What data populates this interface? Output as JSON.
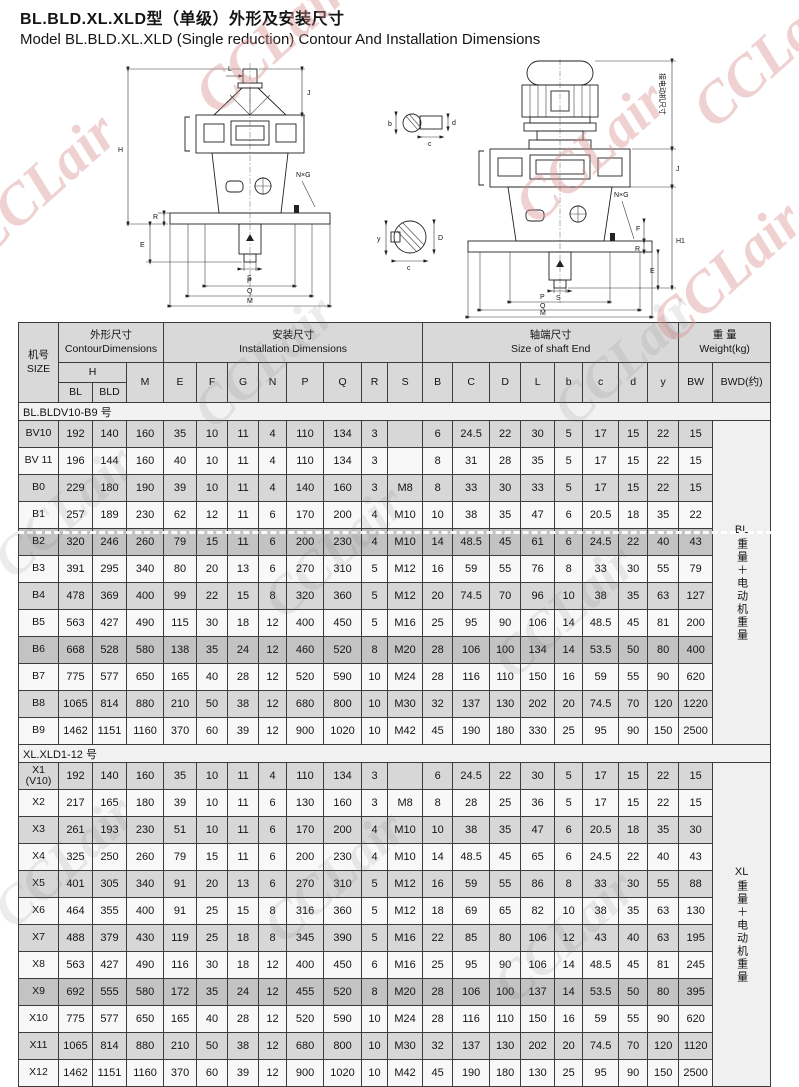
{
  "page": {
    "title_zh": "BL.BLD.XL.XLD型（单级）外形及安装尺寸",
    "title_en": "Model BL.BLD.XL.XLD  (Single  reduction) Contour And Installation Dimensions"
  },
  "watermark": {
    "text": "CCLair"
  },
  "drawings": {
    "left": {
      "H": "H",
      "L": "L",
      "J": "J",
      "NXG": "N×G",
      "E": "E",
      "R": "R",
      "S": "S",
      "P": "P",
      "Q": "Q",
      "M": "M"
    },
    "right": {
      "motor": "接电动机尺寸",
      "J": "J",
      "H1": "H1",
      "NXG": "N×G",
      "F": "F",
      "R": "R",
      "E": "E",
      "S": "S",
      "P": "P",
      "Q": "Q",
      "M": "M"
    },
    "detail_top": {
      "b": "b",
      "d": "d",
      "c": "c"
    },
    "detail_bottom": {
      "y": "y",
      "D": "D",
      "c": "c"
    }
  },
  "table": {
    "col_size_zh": "机号",
    "col_size_en": "SIZE",
    "grp_contour_zh": "外形尺寸",
    "grp_contour_en": "ContourDimensions",
    "grp_install_zh": "安装尺寸",
    "grp_install_en": "Installation   Dimensions",
    "grp_shaft_zh": "轴端尺寸",
    "grp_shaft_en": "Size of shaft End",
    "grp_weight_zh": "重 量",
    "grp_weight_en": "Weight(kg)",
    "col_h": "H",
    "col_bl": "BL",
    "col_bld": "BLD",
    "cols": [
      "M",
      "E",
      "F",
      "G",
      "N",
      "P",
      "Q",
      "R",
      "S",
      "B",
      "C",
      "D",
      "L",
      "b",
      "c",
      "d",
      "y",
      "BW",
      "BWD(约)"
    ],
    "sections": [
      {
        "label": "BL.BLDV10-B9 号",
        "weight_label": "BL",
        "weight_note": "重量＋电动机重量",
        "rows": [
          {
            "size": "BV10",
            "shade": "gray",
            "values": [
              "192",
              "140",
              "160",
              "35",
              "10",
              "11",
              "4",
              "110",
              "134",
              "3",
              "",
              "6",
              "24.5",
              "22",
              "30",
              "5",
              "17",
              "15",
              "22",
              "15"
            ]
          },
          {
            "size": "BV 11",
            "shade": "white",
            "values": [
              "196",
              "144",
              "160",
              "40",
              "10",
              "11",
              "4",
              "110",
              "134",
              "3",
              "",
              "8",
              "31",
              "28",
              "35",
              "5",
              "17",
              "15",
              "22",
              "15"
            ]
          },
          {
            "size": "B0",
            "shade": "gray",
            "values": [
              "229",
              "180",
              "190",
              "39",
              "10",
              "11",
              "4",
              "140",
              "160",
              "3",
              "M8",
              "8",
              "33",
              "30",
              "33",
              "5",
              "17",
              "15",
              "22",
              "15"
            ]
          },
          {
            "size": "B1",
            "shade": "white",
            "values": [
              "257",
              "189",
              "230",
              "62",
              "12",
              "11",
              "6",
              "170",
              "200",
              "4",
              "M10",
              "10",
              "38",
              "35",
              "47",
              "6",
              "20.5",
              "18",
              "35",
              "22"
            ]
          },
          {
            "size": "B2",
            "shade": "dark",
            "values": [
              "320",
              "246",
              "260",
              "79",
              "15",
              "11",
              "6",
              "200",
              "230",
              "4",
              "M10",
              "14",
              "48.5",
              "45",
              "61",
              "6",
              "24.5",
              "22",
              "40",
              "43"
            ]
          },
          {
            "size": "B3",
            "shade": "white",
            "values": [
              "391",
              "295",
              "340",
              "80",
              "20",
              "13",
              "6",
              "270",
              "310",
              "5",
              "M12",
              "16",
              "59",
              "55",
              "76",
              "8",
              "33",
              "30",
              "55",
              "79"
            ]
          },
          {
            "size": "B4",
            "shade": "gray",
            "values": [
              "478",
              "369",
              "400",
              "99",
              "22",
              "15",
              "8",
              "320",
              "360",
              "5",
              "M12",
              "20",
              "74.5",
              "70",
              "96",
              "10",
              "38",
              "35",
              "63",
              "127"
            ]
          },
          {
            "size": "B5",
            "shade": "white",
            "values": [
              "563",
              "427",
              "490",
              "115",
              "30",
              "18",
              "12",
              "400",
              "450",
              "5",
              "M16",
              "25",
              "95",
              "90",
              "106",
              "14",
              "48.5",
              "45",
              "81",
              "200"
            ]
          },
          {
            "size": "B6",
            "shade": "dark",
            "values": [
              "668",
              "528",
              "580",
              "138",
              "35",
              "24",
              "12",
              "460",
              "520",
              "8",
              "M20",
              "28",
              "106",
              "100",
              "134",
              "14",
              "53.5",
              "50",
              "80",
              "400"
            ]
          },
          {
            "size": "B7",
            "shade": "white",
            "values": [
              "775",
              "577",
              "650",
              "165",
              "40",
              "28",
              "12",
              "520",
              "590",
              "10",
              "M24",
              "28",
              "116",
              "110",
              "150",
              "16",
              "59",
              "55",
              "90",
              "620"
            ]
          },
          {
            "size": "B8",
            "shade": "gray",
            "values": [
              "1065",
              "814",
              "880",
              "210",
              "50",
              "38",
              "12",
              "680",
              "800",
              "10",
              "M30",
              "32",
              "137",
              "130",
              "202",
              "20",
              "74.5",
              "70",
              "120",
              "1220"
            ]
          },
          {
            "size": "B9",
            "shade": "white",
            "values": [
              "1462",
              "1151",
              "1160",
              "370",
              "60",
              "39",
              "12",
              "900",
              "1020",
              "10",
              "M42",
              "45",
              "190",
              "180",
              "330",
              "25",
              "95",
              "90",
              "150",
              "2500"
            ]
          }
        ]
      },
      {
        "label": "XL.XLD1-12 号",
        "weight_label": "XL",
        "weight_note": "重量＋电动机重量",
        "rows": [
          {
            "size": "X1\n(V10)",
            "shade": "gray",
            "values": [
              "192",
              "140",
              "160",
              "35",
              "10",
              "11",
              "4",
              "110",
              "134",
              "3",
              "",
              "6",
              "24.5",
              "22",
              "30",
              "5",
              "17",
              "15",
              "22",
              "15"
            ]
          },
          {
            "size": "X2",
            "shade": "white",
            "values": [
              "217",
              "165",
              "180",
              "39",
              "10",
              "11",
              "6",
              "130",
              "160",
              "3",
              "M8",
              "8",
              "28",
              "25",
              "36",
              "5",
              "17",
              "15",
              "22",
              "15"
            ]
          },
          {
            "size": "X3",
            "shade": "gray",
            "values": [
              "261",
              "193",
              "230",
              "51",
              "10",
              "11",
              "6",
              "170",
              "200",
              "4",
              "M10",
              "10",
              "38",
              "35",
              "47",
              "6",
              "20.5",
              "18",
              "35",
              "30"
            ]
          },
          {
            "size": "X4",
            "shade": "white",
            "values": [
              "325",
              "250",
              "260",
              "79",
              "15",
              "11",
              "6",
              "200",
              "230",
              "4",
              "M10",
              "14",
              "48.5",
              "45",
              "65",
              "6",
              "24.5",
              "22",
              "40",
              "43"
            ]
          },
          {
            "size": "X5",
            "shade": "gray",
            "values": [
              "401",
              "305",
              "340",
              "91",
              "20",
              "13",
              "6",
              "270",
              "310",
              "5",
              "M12",
              "16",
              "59",
              "55",
              "86",
              "8",
              "33",
              "30",
              "55",
              "88"
            ]
          },
          {
            "size": "X6",
            "shade": "white",
            "values": [
              "464",
              "355",
              "400",
              "91",
              "25",
              "15",
              "8",
              "316",
              "360",
              "5",
              "M12",
              "18",
              "69",
              "65",
              "82",
              "10",
              "38",
              "35",
              "63",
              "130"
            ]
          },
          {
            "size": "X7",
            "shade": "gray",
            "values": [
              "488",
              "379",
              "430",
              "119",
              "25",
              "18",
              "8",
              "345",
              "390",
              "5",
              "M16",
              "22",
              "85",
              "80",
              "106",
              "12",
              "43",
              "40",
              "63",
              "195"
            ]
          },
          {
            "size": "X8",
            "shade": "white",
            "values": [
              "563",
              "427",
              "490",
              "116",
              "30",
              "18",
              "12",
              "400",
              "450",
              "6",
              "M16",
              "25",
              "95",
              "90",
              "106",
              "14",
              "48.5",
              "45",
              "81",
              "245"
            ]
          },
          {
            "size": "X9",
            "shade": "dark",
            "values": [
              "692",
              "555",
              "580",
              "172",
              "35",
              "24",
              "12",
              "455",
              "520",
              "8",
              "M20",
              "28",
              "106",
              "100",
              "137",
              "14",
              "53.5",
              "50",
              "80",
              "395"
            ]
          },
          {
            "size": "X10",
            "shade": "white",
            "values": [
              "775",
              "577",
              "650",
              "165",
              "40",
              "28",
              "12",
              "520",
              "590",
              "10",
              "M24",
              "28",
              "116",
              "110",
              "150",
              "16",
              "59",
              "55",
              "90",
              "620"
            ]
          },
          {
            "size": "X11",
            "shade": "gray",
            "values": [
              "1065",
              "814",
              "880",
              "210",
              "50",
              "38",
              "12",
              "680",
              "800",
              "10",
              "M30",
              "32",
              "137",
              "130",
              "202",
              "20",
              "74.5",
              "70",
              "120",
              "1120"
            ]
          },
          {
            "size": "X12",
            "shade": "white",
            "values": [
              "1462",
              "1151",
              "1160",
              "370",
              "60",
              "39",
              "12",
              "900",
              "1020",
              "10",
              "M42",
              "45",
              "190",
              "180",
              "130",
              "25",
              "95",
              "90",
              "150",
              "2500"
            ]
          }
        ]
      }
    ]
  }
}
